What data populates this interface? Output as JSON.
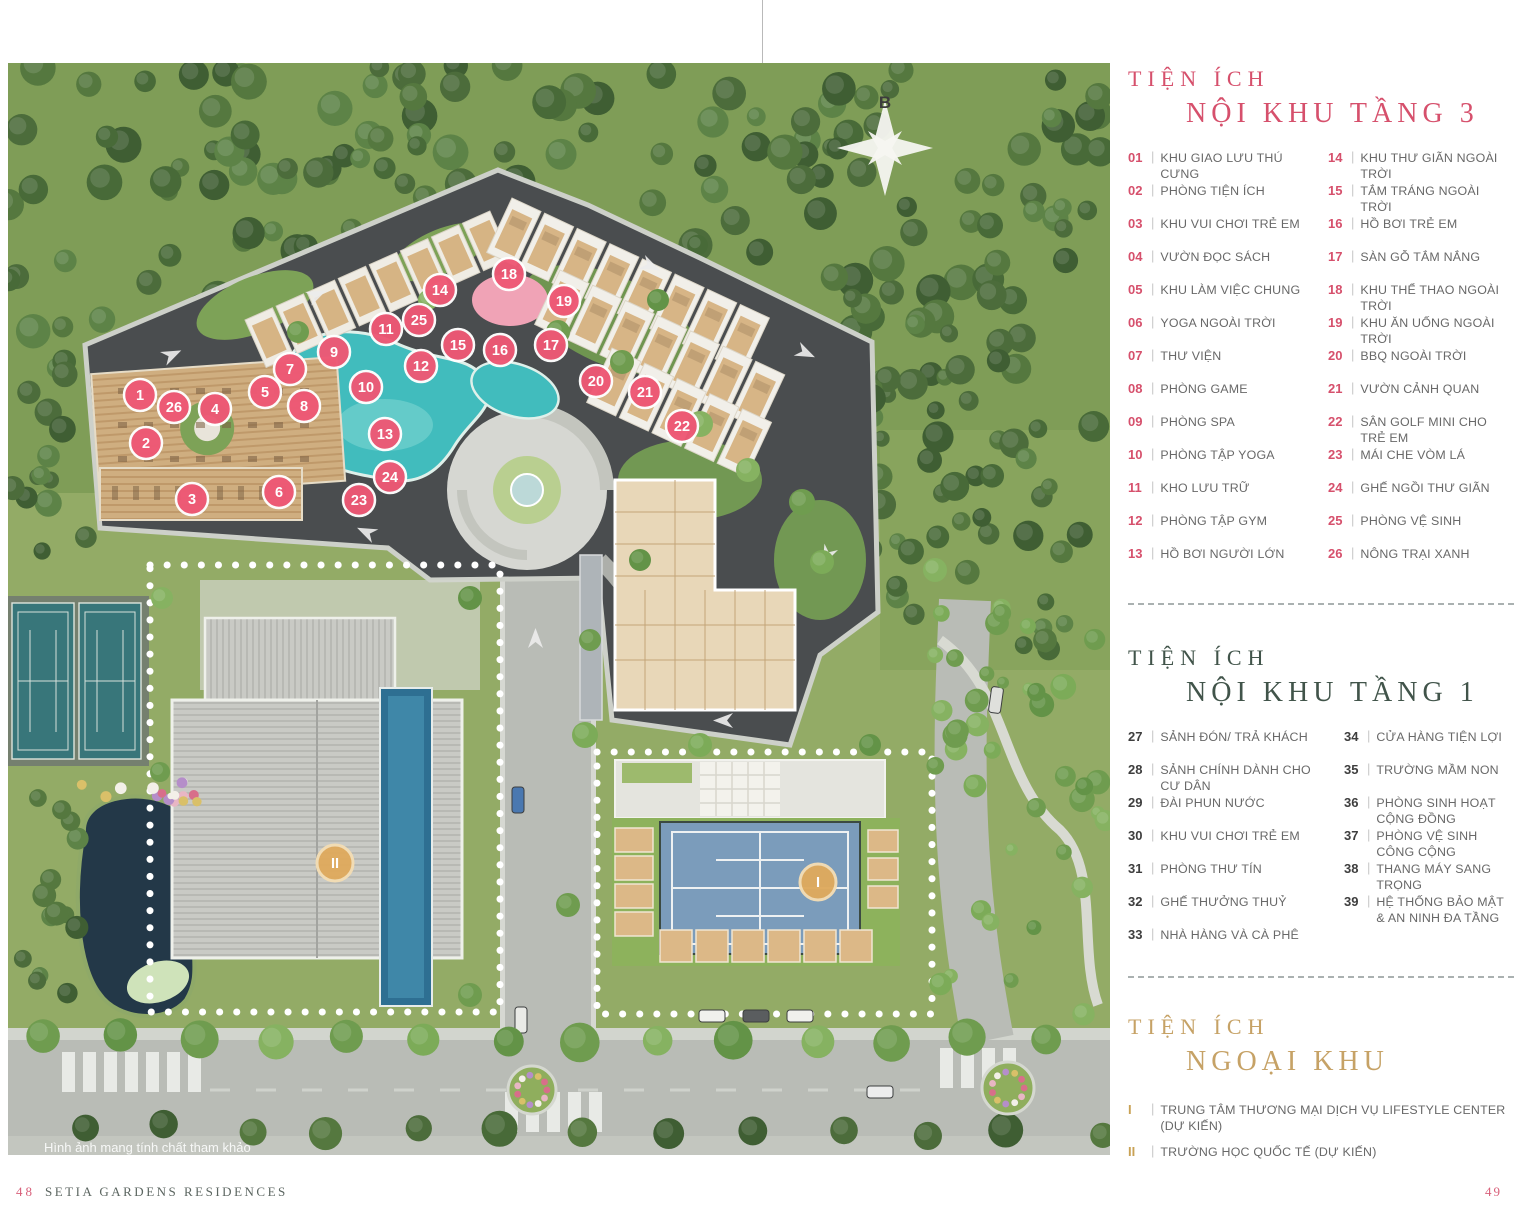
{
  "footer": {
    "left_number": "48",
    "title": "SETIA GARDENS RESIDENCES",
    "right_number": "49"
  },
  "map": {
    "watermark": "Hình ảnh mang tính chất tham khảo",
    "compass_label": "B"
  },
  "colors": {
    "pink": "#d6506c",
    "green": "#41544a",
    "gold": "#c6a266",
    "marker_pink": "#ee5875",
    "marker_gold": "#dfaa5e"
  },
  "legend_sections": [
    {
      "eyebrow": "TIỆN ÍCH",
      "title": "NỘI KHU TẦNG 3",
      "title_color": "#d6506c",
      "num_color": "#d6506c",
      "columns": [
        [
          {
            "num": "01",
            "label": "KHU GIAO LƯU THÚ CƯNG"
          },
          {
            "num": "02",
            "label": "PHÒNG TIỆN ÍCH"
          },
          {
            "num": "03",
            "label": "KHU VUI CHƠI TRẺ EM"
          },
          {
            "num": "04",
            "label": "VƯỜN ĐỌC SÁCH"
          },
          {
            "num": "05",
            "label": "KHU LÀM VIỆC CHUNG"
          },
          {
            "num": "06",
            "label": "YOGA NGOÀI TRỜI"
          },
          {
            "num": "07",
            "label": "THƯ VIỆN"
          },
          {
            "num": "08",
            "label": "PHÒNG GAME"
          },
          {
            "num": "09",
            "label": "PHÒNG SPA"
          },
          {
            "num": "10",
            "label": "PHÒNG TẬP YOGA"
          },
          {
            "num": "11",
            "label": "KHO LƯU TRỮ"
          },
          {
            "num": "12",
            "label": "PHÒNG TẬP GYM"
          },
          {
            "num": "13",
            "label": "HỒ BƠI NGƯỜI LỚN"
          }
        ],
        [
          {
            "num": "14",
            "label": "KHU THƯ GIÃN NGOÀI TRỜI"
          },
          {
            "num": "15",
            "label": "TẮM TRÁNG NGOÀI TRỜI"
          },
          {
            "num": "16",
            "label": "HỒ BƠI TRẺ EM"
          },
          {
            "num": "17",
            "label": "SÀN GỖ TẮM NẮNG"
          },
          {
            "num": "18",
            "label": "KHU THỂ THAO NGOÀI TRỜI"
          },
          {
            "num": "19",
            "label": "KHU ĂN UỐNG NGOÀI TRỜI"
          },
          {
            "num": "20",
            "label": "BBQ NGOÀI TRỜI"
          },
          {
            "num": "21",
            "label": "VƯỜN CẢNH QUAN"
          },
          {
            "num": "22",
            "label": "SÂN GOLF MINI CHO TRẺ EM"
          },
          {
            "num": "23",
            "label": "MÁI CHE VÒM LÁ"
          },
          {
            "num": "24",
            "label": "GHẾ NGỒI THƯ GIÃN"
          },
          {
            "num": "25",
            "label": "PHÒNG VỆ SINH"
          },
          {
            "num": "26",
            "label": "NÔNG TRẠI XANH"
          }
        ]
      ]
    },
    {
      "eyebrow": "TIỆN ÍCH",
      "title": "NỘI KHU TẦNG 1",
      "title_color": "#41544a",
      "num_color": "#3e3e3e",
      "columns": [
        [
          {
            "num": "27",
            "label": "SẢNH ĐÓN/ TRẢ KHÁCH"
          },
          {
            "num": "28",
            "label": "SẢNH CHÍNH DÀNH CHO CƯ DÂN"
          },
          {
            "num": "29",
            "label": "ĐÀI PHUN NƯỚC"
          },
          {
            "num": "30",
            "label": "KHU VUI CHƠI TRẺ EM"
          },
          {
            "num": "31",
            "label": "PHÒNG THƯ TÍN"
          },
          {
            "num": "32",
            "label": "GHẾ THƯỞNG THUỶ"
          },
          {
            "num": "33",
            "label": "NHÀ HÀNG VÀ CÀ PHÊ"
          }
        ],
        [
          {
            "num": "34",
            "label": "CỬA HÀNG TIỆN LỢI"
          },
          {
            "num": "35",
            "label": "TRƯỜNG MẦM NON"
          },
          {
            "num": "36",
            "label": "PHÒNG SINH HOẠT CỘNG ĐỒNG"
          },
          {
            "num": "37",
            "label": "PHÒNG VỆ SINH CÔNG CỘNG"
          },
          {
            "num": "38",
            "label": "THANG MÁY SANG TRỌNG"
          },
          {
            "num": "39",
            "label": "HỆ THỐNG BẢO MẬT",
            "label2": "& AN NINH ĐA TẦNG"
          }
        ]
      ]
    },
    {
      "eyebrow": "TIỆN ÍCH",
      "title": "NGOẠI KHU",
      "title_color": "#c6a266",
      "num_color": "#c9a255",
      "columns": [
        [
          {
            "num": "I",
            "label": "TRUNG TÂM THƯƠNG MẠI DỊCH VỤ LIFESTYLE CENTER (DỰ KIẾN)"
          },
          {
            "num": "II",
            "label": "TRƯỜNG HỌC QUỐC TẾ (DỰ KIẾN)"
          }
        ]
      ]
    }
  ],
  "map_markers": {
    "pink": [
      {
        "n": "1",
        "x": 140,
        "y": 395
      },
      {
        "n": "2",
        "x": 146,
        "y": 443
      },
      {
        "n": "3",
        "x": 192,
        "y": 499
      },
      {
        "n": "4",
        "x": 215,
        "y": 409
      },
      {
        "n": "5",
        "x": 265,
        "y": 392
      },
      {
        "n": "6",
        "x": 279,
        "y": 492
      },
      {
        "n": "7",
        "x": 290,
        "y": 369
      },
      {
        "n": "8",
        "x": 304,
        "y": 406
      },
      {
        "n": "9",
        "x": 334,
        "y": 352
      },
      {
        "n": "10",
        "x": 366,
        "y": 387
      },
      {
        "n": "11",
        "x": 386,
        "y": 329
      },
      {
        "n": "12",
        "x": 421,
        "y": 366
      },
      {
        "n": "13",
        "x": 385,
        "y": 434
      },
      {
        "n": "14",
        "x": 440,
        "y": 290
      },
      {
        "n": "15",
        "x": 458,
        "y": 345
      },
      {
        "n": "16",
        "x": 500,
        "y": 350
      },
      {
        "n": "17",
        "x": 551,
        "y": 345
      },
      {
        "n": "18",
        "x": 509,
        "y": 274
      },
      {
        "n": "19",
        "x": 564,
        "y": 301
      },
      {
        "n": "20",
        "x": 596,
        "y": 381
      },
      {
        "n": "21",
        "x": 645,
        "y": 392
      },
      {
        "n": "22",
        "x": 682,
        "y": 426
      },
      {
        "n": "23",
        "x": 359,
        "y": 500
      },
      {
        "n": "24",
        "x": 390,
        "y": 477
      },
      {
        "n": "25",
        "x": 419,
        "y": 320
      },
      {
        "n": "26",
        "x": 174,
        "y": 407
      }
    ],
    "gold": [
      {
        "n": "I",
        "x": 818,
        "y": 882
      },
      {
        "n": "II",
        "x": 335,
        "y": 863
      }
    ]
  }
}
